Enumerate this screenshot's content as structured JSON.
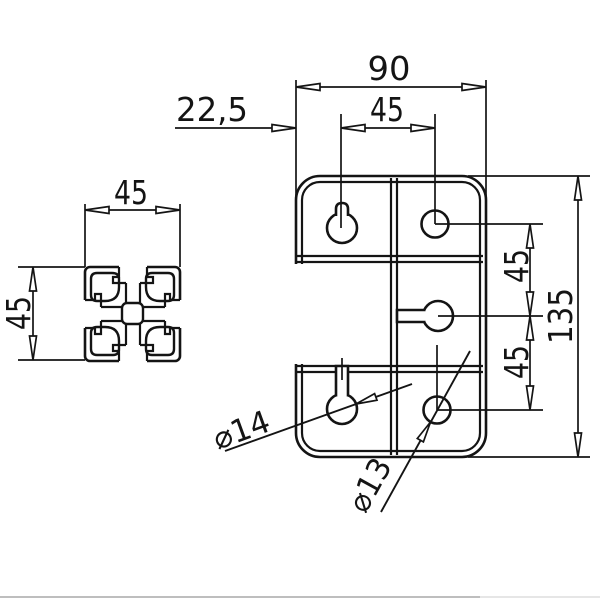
{
  "drawing": {
    "type": "technical-drawing",
    "line_color": "#141414",
    "profile": {
      "width_label": "45",
      "height_label": "45"
    },
    "plate": {
      "width_label": "90",
      "offset_label": "22,5",
      "col_spacing_label": "45",
      "height_label": "135",
      "row_spacing_upper_label": "45",
      "row_spacing_lower_label": "45",
      "keyhole_dia_label": "⌀14",
      "hole_dia_label": "⌀13"
    }
  }
}
